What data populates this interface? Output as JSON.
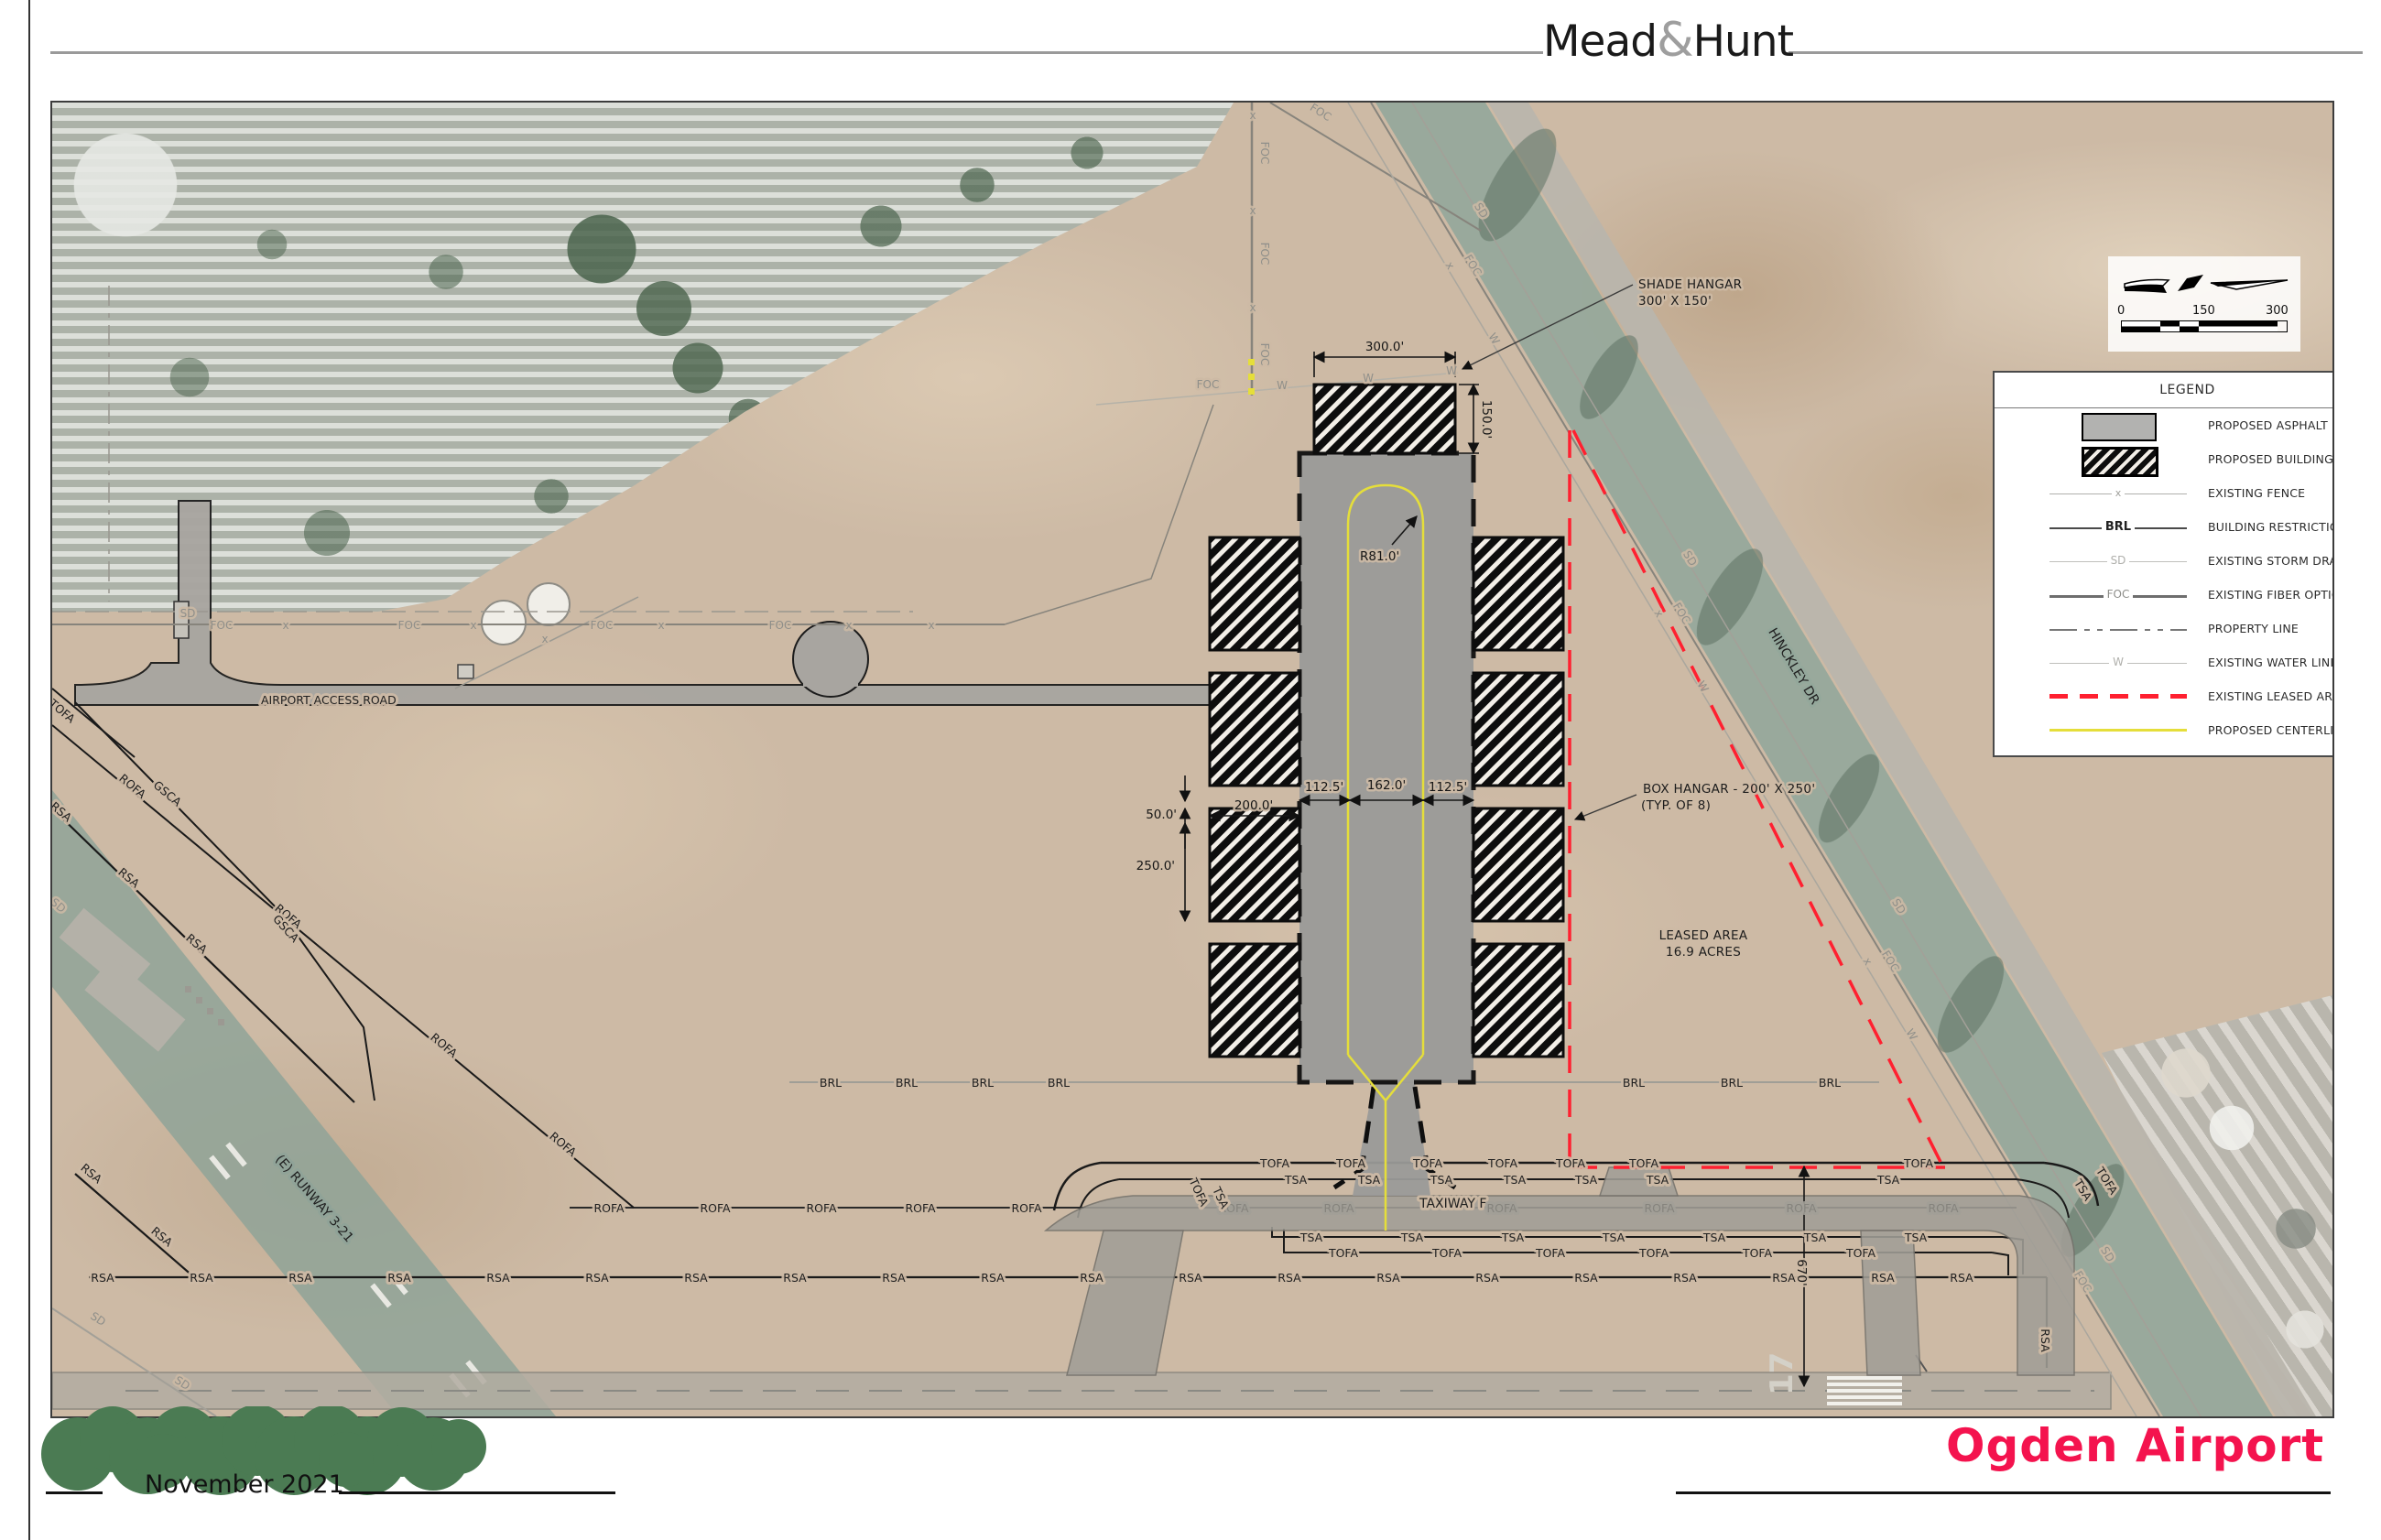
{
  "header": {
    "brand_left": "Mead",
    "brand_amp": "&",
    "brand_right": "Hunt"
  },
  "footer": {
    "date": "November 2021",
    "project": "Ogden Airport"
  },
  "colors": {
    "title_red": "#f4134e",
    "leased_red": "#ff2030",
    "centerline_yellow": "#e5de3a",
    "logo_green": "#4b7b53",
    "proposed_asphalt_gray": "#9a9a98"
  },
  "scalebar": {
    "start": "0",
    "mid": "150",
    "end": "300"
  },
  "legend": {
    "title": "LEGEND",
    "items": [
      {
        "type": "asphalt",
        "symbol": "proposed-asphalt-swatch",
        "label": "PROPOSED ASPHALT"
      },
      {
        "type": "building",
        "symbol": "proposed-building-swatch",
        "label": "PROPOSED BUILDING"
      },
      {
        "type": "fence",
        "symbol": "existing-fence-line",
        "label": "EXISTING FENCE",
        "tag": "x"
      },
      {
        "type": "brl",
        "symbol": "brl-line",
        "label": "BUILDING RESTRICTION LINE (60')",
        "tag": "BRL"
      },
      {
        "type": "sd",
        "symbol": "storm-drain-line",
        "label": "EXISTING STORM DRAIN",
        "tag": "SD"
      },
      {
        "type": "foc",
        "symbol": "fiber-optic-line",
        "label": "EXISTING FIBER OPTIC CABLE",
        "tag": "FOC"
      },
      {
        "type": "property",
        "symbol": "property-line",
        "label": "PROPERTY LINE"
      },
      {
        "type": "water",
        "symbol": "water-line",
        "label": "EXISTING WATER LINE",
        "tag": "W"
      },
      {
        "type": "leased",
        "symbol": "leased-area-line",
        "label": "EXISTING LEASED AREA"
      },
      {
        "type": "centerline",
        "symbol": "centerline-marking-line",
        "label": "PROPOSED CENTERLINE MARKING"
      }
    ]
  },
  "map": {
    "labels": {
      "taxiway": "TAXIWAY F",
      "access_road": "AIRPORT ACCESS ROAD",
      "hinckley": "HINCKLEY DR",
      "runway": "(E) RUNWAY 3-21",
      "runway_number": "17"
    },
    "callouts": {
      "shade_hangar_1": "SHADE HANGAR",
      "shade_hangar_2": "300' X 150'",
      "box_hangar_1": "BOX HANGAR - 200' X 250'",
      "box_hangar_2": "(TYP. OF 8)",
      "leased_1": "LEASED AREA",
      "leased_2": "16.9 ACRES"
    },
    "dimensions": {
      "shade_width": "300.0'",
      "shade_depth": "150.0'",
      "apron_left": "112.5'",
      "apron_center": "162.0'",
      "apron_right": "112.5'",
      "hangar_width": "200.0'",
      "hangar_gap": "50.0'",
      "hangar_depth": "250.0'",
      "turn_radius": "R81.0'",
      "runway_offset": "670'"
    },
    "line_labels": {
      "brl": "BRL",
      "rofa": "ROFA",
      "rsa": "RSA",
      "tofa": "TOFA",
      "tsa": "TSA",
      "sd": "SD",
      "foc": "FOC",
      "w": "W",
      "x": "x",
      "gsca": "GSCA"
    }
  }
}
